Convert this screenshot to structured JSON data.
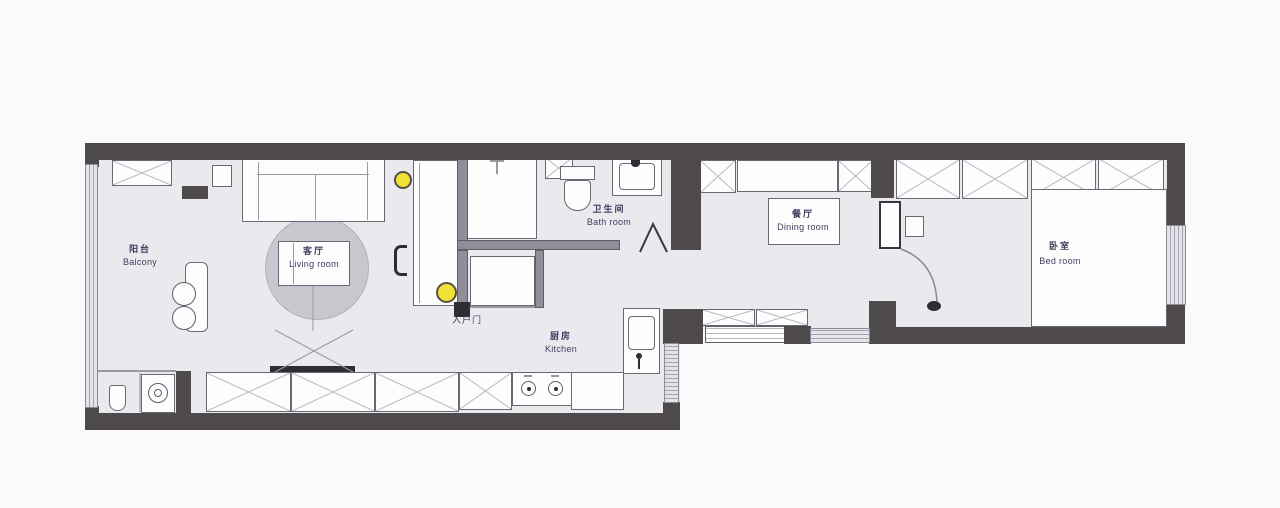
{
  "title": "apartment-floor-plan",
  "rooms": {
    "balcony": {
      "zh": "阳台",
      "en": "Balcony"
    },
    "living": {
      "zh": "客厅",
      "en": "Living room"
    },
    "bath": {
      "zh": "卫生间",
      "en": "Bath room"
    },
    "entry": {
      "zh": "入户门",
      "en": ""
    },
    "kitchen": {
      "zh": "厨房",
      "en": "Kitchen"
    },
    "dining": {
      "zh": "餐厅",
      "en": "Dining room"
    },
    "bedroom": {
      "zh": "卧室",
      "en": "Bed room"
    }
  },
  "colors": {
    "page_bg": "#fbfbfd",
    "wall": "#4e4a4c",
    "partition": "#918e99",
    "floor": "#e9e9ee",
    "furniture": "#fdfdfe",
    "rug": "#c8c7cd",
    "accent_light": "#f2e135",
    "label_text": "#403e5e",
    "window_fill": "#e3e3e9",
    "dark_detail": "#2f2d34"
  }
}
